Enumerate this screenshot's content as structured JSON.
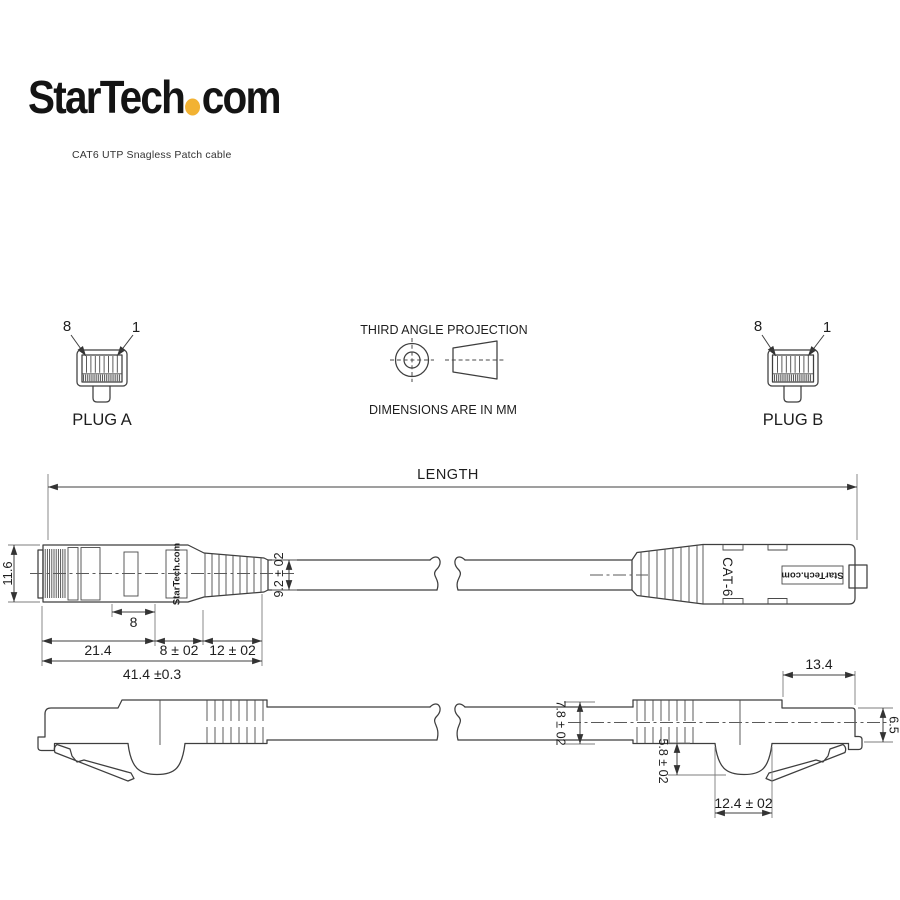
{
  "brand": {
    "name_prefix": "StarTech",
    "name_suffix": "com",
    "dot_color": "#F2B233",
    "tagline": "CAT6 UTP Snagless Patch cable"
  },
  "projection_note": {
    "title": "THIRD ANGLE PROJECTION",
    "units": "DIMENSIONS ARE IN MM"
  },
  "plug_a": {
    "label": "PLUG A",
    "pin_8": "8",
    "pin_1": "1"
  },
  "plug_b": {
    "label": "PLUG B",
    "pin_8": "8",
    "pin_1": "1"
  },
  "length_dim": {
    "label": "LENGTH"
  },
  "side_view": {
    "plug_height": "11.6",
    "contact_len": "8",
    "body_len": "21.4",
    "collar_len": "8 ± 02",
    "boot_len": "12 ± 02",
    "overall_len": "41.4 ±0.3",
    "cable_dia": "9.2 ± 02",
    "plug_a_marking": "StarTech.com"
  },
  "top_marks": {
    "cat6": "CAT-6",
    "brand_label": "StarTech.com"
  },
  "bottom_view": {
    "cable_dia": "7.8 ± 02",
    "latch_depth": "5.8 ± 02",
    "latch_opening": "12.4 ± 02",
    "latch_len": "13.4",
    "nose_height": "6.5"
  }
}
